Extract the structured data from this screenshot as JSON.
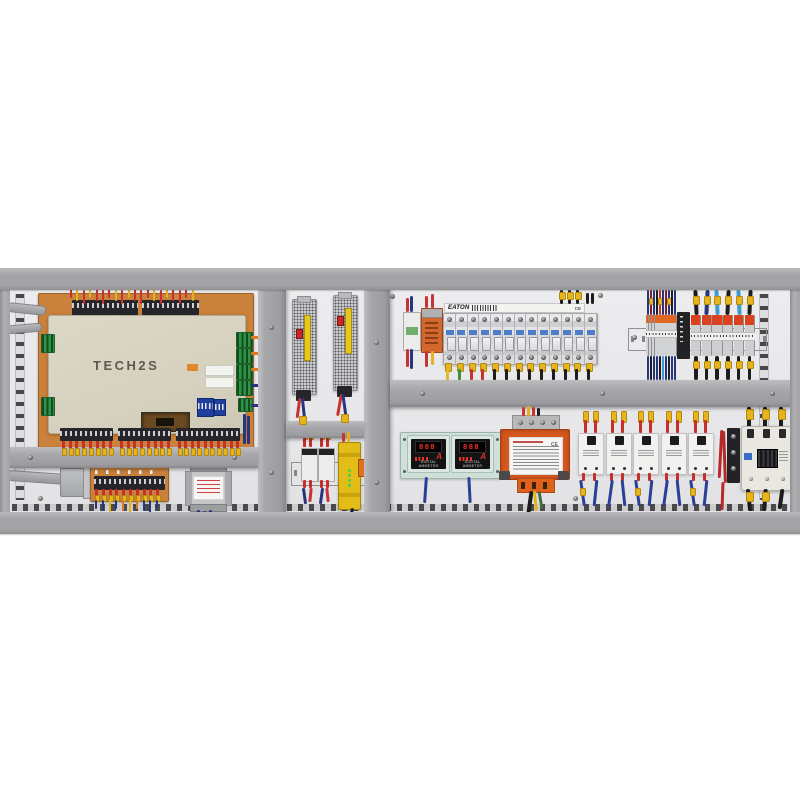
{
  "palette": {
    "frame": "#a7a7aa",
    "divider": "#a4a4a8",
    "back_panel": "#eaeaec",
    "pcb_orange": "#c9813b",
    "plc_cover": "#dad5c2",
    "wire_red": "#c73232",
    "wire_yellow": "#e2b31e",
    "wire_blue": "#27357f",
    "wire_black": "#1e1e1e",
    "wire_light_blue": "#3b9bd6",
    "wire_orange": "#e07a22",
    "breaker_body": "#dcdcdf",
    "breaker_label_blue": "#4d7cc9",
    "terminal_lever_red": "#d8421e",
    "terminal_top_orange": "#e06626",
    "meter_plate": "#cfe0d8",
    "meter_digit_red": "#ff4434",
    "transformer_orange": "#d8581f",
    "safety_relay_yellow": "#e2bc17",
    "ssr_white": "#f1f1f0",
    "contactor_ivory": "#e9e7e0",
    "psu_label_yellow": "#e5c722"
  },
  "plc": {
    "model_label": "TECH2S"
  },
  "power_supplies": {
    "count": 2
  },
  "mid_din": {
    "relay_count": 2
  },
  "breakers": {
    "brand_label": "EATON",
    "ce_label": "CE",
    "pole_count": 13
  },
  "terminal_blocks": {
    "left_count": 10,
    "right_count": 6
  },
  "meters": {
    "count": 2,
    "digits": "888",
    "unit_label": "A",
    "caption": "DIGITAL AMMETER"
  },
  "control_transformer": {
    "ce_label": "CE"
  },
  "ssr_bank": {
    "count": 5
  },
  "bottom_board": {
    "terminal_count": 10
  },
  "wiring": {
    "plc_top_pattern": [
      "#c73232",
      "#e2b31e",
      "#c73232",
      "#e2b31e",
      "#c73232",
      "#c73232"
    ],
    "plc_bottom_groups": [
      8,
      8,
      10
    ],
    "breaker_bottom": [
      "#d6be2a",
      "#3f8f3f",
      "#c73232",
      "#c73232",
      "#1e1e1e",
      "#1e1e1e",
      "#1e1e1e",
      "#1e1e1e",
      "#1e1e1e",
      "#1e1e1e",
      "#1e1e1e",
      "#1e1e1e",
      "#1e1e1e"
    ],
    "tb_left_top": [
      "#27357f",
      "#801f2c",
      "#27357f",
      "#1e1e1e",
      "#c73232",
      "#27357f",
      "#801f2c",
      "#27357f",
      "#1e1e1e",
      "#27357f"
    ],
    "tb_left_bottom": [
      "#27357f",
      "#1e1e1e",
      "#27357f",
      "#27357f",
      "#1e1e1e",
      "#3b9bd6",
      "#27357f",
      "#1e1e1e",
      "#27357f",
      "#27357f"
    ],
    "tb_right_top": [
      "#1e1e1e",
      "#27357f",
      "#3b9bd6",
      "#1e1e1e",
      "#3b9bd6",
      "#1e1e1e"
    ],
    "tb_right_bottom": [
      "#1e1e1e",
      "#1e1e1e",
      "#1e1e1e",
      "#1e1e1e",
      "#1e1e1e",
      "#1e1e1e"
    ],
    "bl_board_bottom": [
      "#27357f",
      "#27357f",
      "#e2b31e",
      "#27357f",
      "#e07a22",
      "#e2b31e",
      "#e07a22",
      "#27357f",
      "#27357f",
      "#27357f"
    ],
    "ssr_wire": "#2b3f96"
  }
}
